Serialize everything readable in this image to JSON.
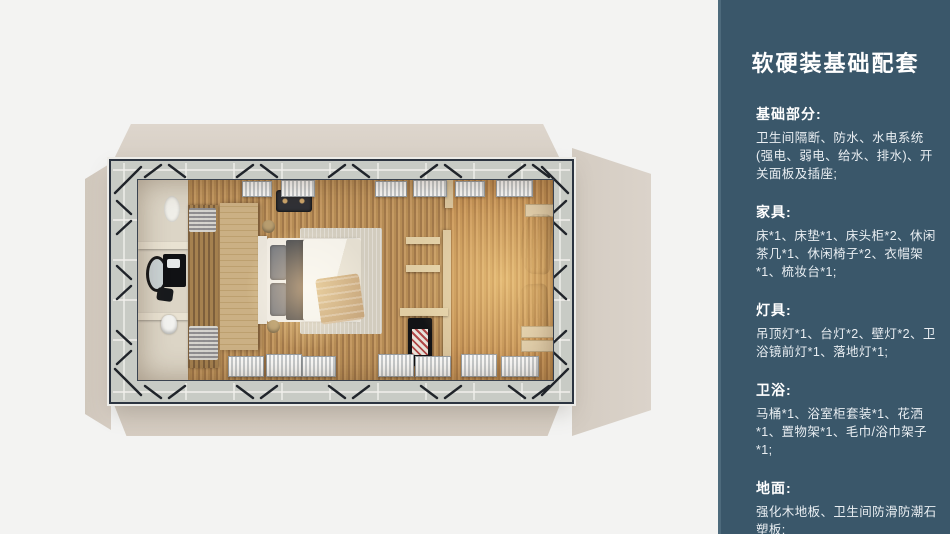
{
  "page": {
    "background": "#f3f3f2"
  },
  "sidebar": {
    "background": "#3a576a",
    "edge_color": "#4d6a7c",
    "text_color": "#ffffff",
    "title": "软硬装基础配套",
    "sections": [
      {
        "heading": "基础部分:",
        "body": "卫生间隔断、防水、水电系统(强电、弱电、给水、排水)、开关面板及插座;"
      },
      {
        "heading": "家具:",
        "body": "床*1、床垫*1、床头柜*2、休闲茶几*1、休闲椅子*2、衣帽架*1、梳妆台*1;"
      },
      {
        "heading": "灯具:",
        "body": "吊顶灯*1、台灯*2、壁灯*2、卫浴镜前灯*1、落地灯*1;"
      },
      {
        "heading": "卫浴:",
        "body": "马桶*1、浴室柜套装*1、花洒*1、置物架*1、毛巾/浴巾架子*1;"
      },
      {
        "heading": "地面:",
        "body": "强化木地板、卫生间防滑防潮石塑板;"
      }
    ]
  },
  "floorplan": {
    "shell_color": "#d8d0c6",
    "frame_color": "#2c3440",
    "deck_color": "#c8cbc5",
    "wood_floor_color": "#bd9259",
    "bathroom_floor_color": "#dcd5c6",
    "lamp_glow_color": "#ffb86e"
  }
}
